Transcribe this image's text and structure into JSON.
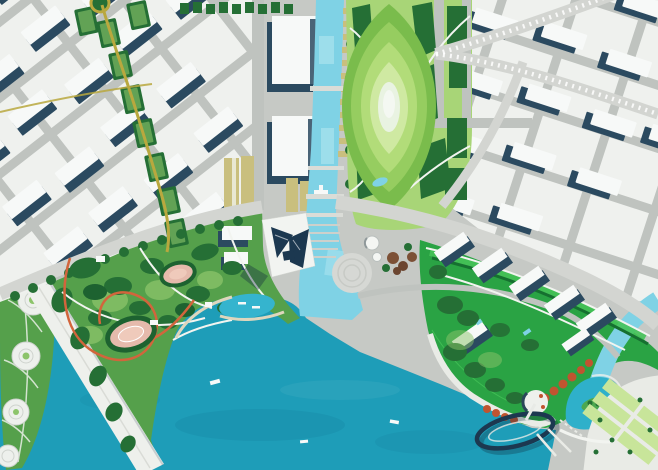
{
  "meta": {
    "title": "Waterfront city masterplan aerial rendering"
  },
  "colors": {
    "base": "#c6c9c5",
    "plot": "#eff1ee",
    "road_major": "#d3d5d1",
    "road_minor": "#bfc3bf",
    "building_white": "#f7f9f8",
    "building_shadow": "#2b4a60",
    "tower_dark": "#1c3850",
    "water_bay": "#1e9db8",
    "water_canal": "#7fd2e5",
    "water_lagoon": "#2fb0ca",
    "water_pond": "#35b4ce",
    "park_green": "#55a04b",
    "tree_dark": "#256f35",
    "tree_deep": "#1d6230",
    "lawn_mid": "#8cc46a",
    "lawn_light": "#a8d577",
    "lawn_pale": "#c8e59a",
    "ribbon_green": "#2aa344",
    "ribbon_lawn": "#45c258",
    "ribbon_dark": "#167030",
    "oval_ring1": "#7abc4c",
    "oval_ring2": "#96cd60",
    "oval_ring3": "#b2dc79",
    "oval_ring4": "#cfe9a2",
    "oval_core": "#e9f3e2",
    "khaki": "#c9bf7e",
    "gold_road": "#b9a83e",
    "trail_orange": "#d2653c",
    "orange_trees": "#c05430",
    "pink_field": "#e5baac",
    "promenade": "#e9ebe6",
    "causeway": "#eef0ec",
    "white_path": "#f2f4f0",
    "beach": "#ded6bd"
  },
  "regions": [
    {
      "id": "nw-district",
      "label": "Northwest white-block city district"
    },
    {
      "id": "ne-district",
      "label": "Northeast white-block city district"
    },
    {
      "id": "central-canal",
      "label": "Central canal with quay piers and exhibition halls"
    },
    {
      "id": "oval-lawn-park",
      "label": "Elliptical terraced lawn park"
    },
    {
      "id": "central-park",
      "label": "Central waterfront park with trails and event ovals"
    },
    {
      "id": "bay",
      "label": "Bay water"
    },
    {
      "id": "leaf-island",
      "label": "Leaf-shaped green island"
    },
    {
      "id": "causeway-bridge",
      "label": "White causeway bridge"
    },
    {
      "id": "landmark-towers",
      "label": "Dark landmark tower cluster on podium"
    },
    {
      "id": "circular-plaza",
      "label": "Circular plaza at canal mouth"
    },
    {
      "id": "residential-ribbon",
      "label": "Green residential ribbon with slab towers"
    },
    {
      "id": "waterfront-promenade",
      "label": "Southeast waterfront promenade"
    },
    {
      "id": "elliptical-pier",
      "label": "Dark elliptical pier ring over water"
    },
    {
      "id": "se-lawn-quarter",
      "label": "Southeast lawn quarter"
    },
    {
      "id": "right-canal",
      "label": "Eastern canal arm"
    },
    {
      "id": "lagoon",
      "label": "Lagoon with green island"
    },
    {
      "id": "gold-route",
      "label": "Golden route with green pocket parks"
    },
    {
      "id": "boulevard-west",
      "label": "Western boulevard"
    },
    {
      "id": "boulevard-east",
      "label": "Eastern boulevard"
    }
  ]
}
